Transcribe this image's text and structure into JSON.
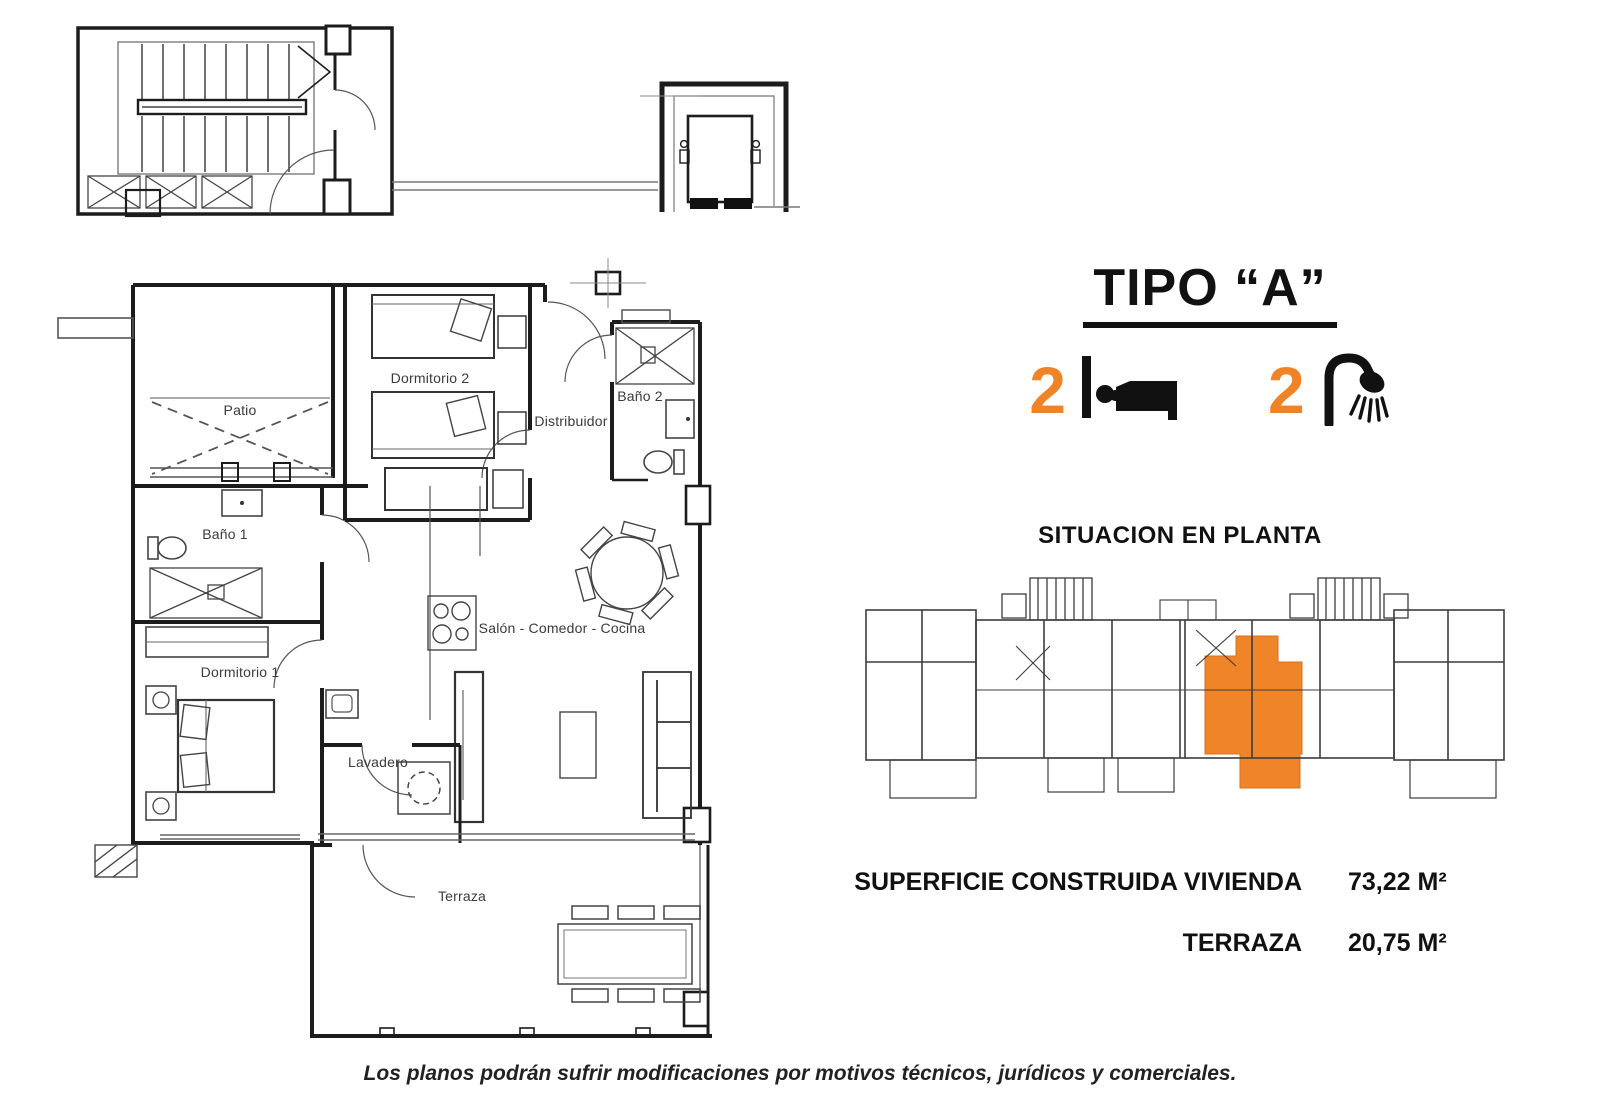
{
  "header": {
    "title": "TIPO “A”"
  },
  "features": {
    "bedrooms": {
      "count": "2",
      "icon": "bed-icon"
    },
    "bathrooms": {
      "count": "2",
      "icon": "shower-icon"
    }
  },
  "site_plan": {
    "heading": "SITUACION EN PLANTA",
    "highlight_color": "#F08428"
  },
  "areas": {
    "rows": [
      {
        "label": "SUPERFICIE CONSTRUIDA VIVIENDA",
        "value": "73,22 M²"
      },
      {
        "label": "TERRAZA",
        "value": "20,75 M²"
      }
    ]
  },
  "floorplan": {
    "rooms": [
      {
        "name": "Patio"
      },
      {
        "name": "Dormitorio 2"
      },
      {
        "name": "Baño 2"
      },
      {
        "name": "Distribuidor"
      },
      {
        "name": "Baño 1"
      },
      {
        "name": "Dormitorio 1"
      },
      {
        "name": "Salón - Comedor - Cocina"
      },
      {
        "name": "Lavadero"
      },
      {
        "name": "Terraza"
      }
    ]
  },
  "footer": {
    "disclaimer": "Los planos podrán sufrir modificaciones por motivos técnicos, jurídicos y comerciales."
  },
  "colors": {
    "accent_orange": "#EF8326",
    "line": "#1C1C1C"
  }
}
